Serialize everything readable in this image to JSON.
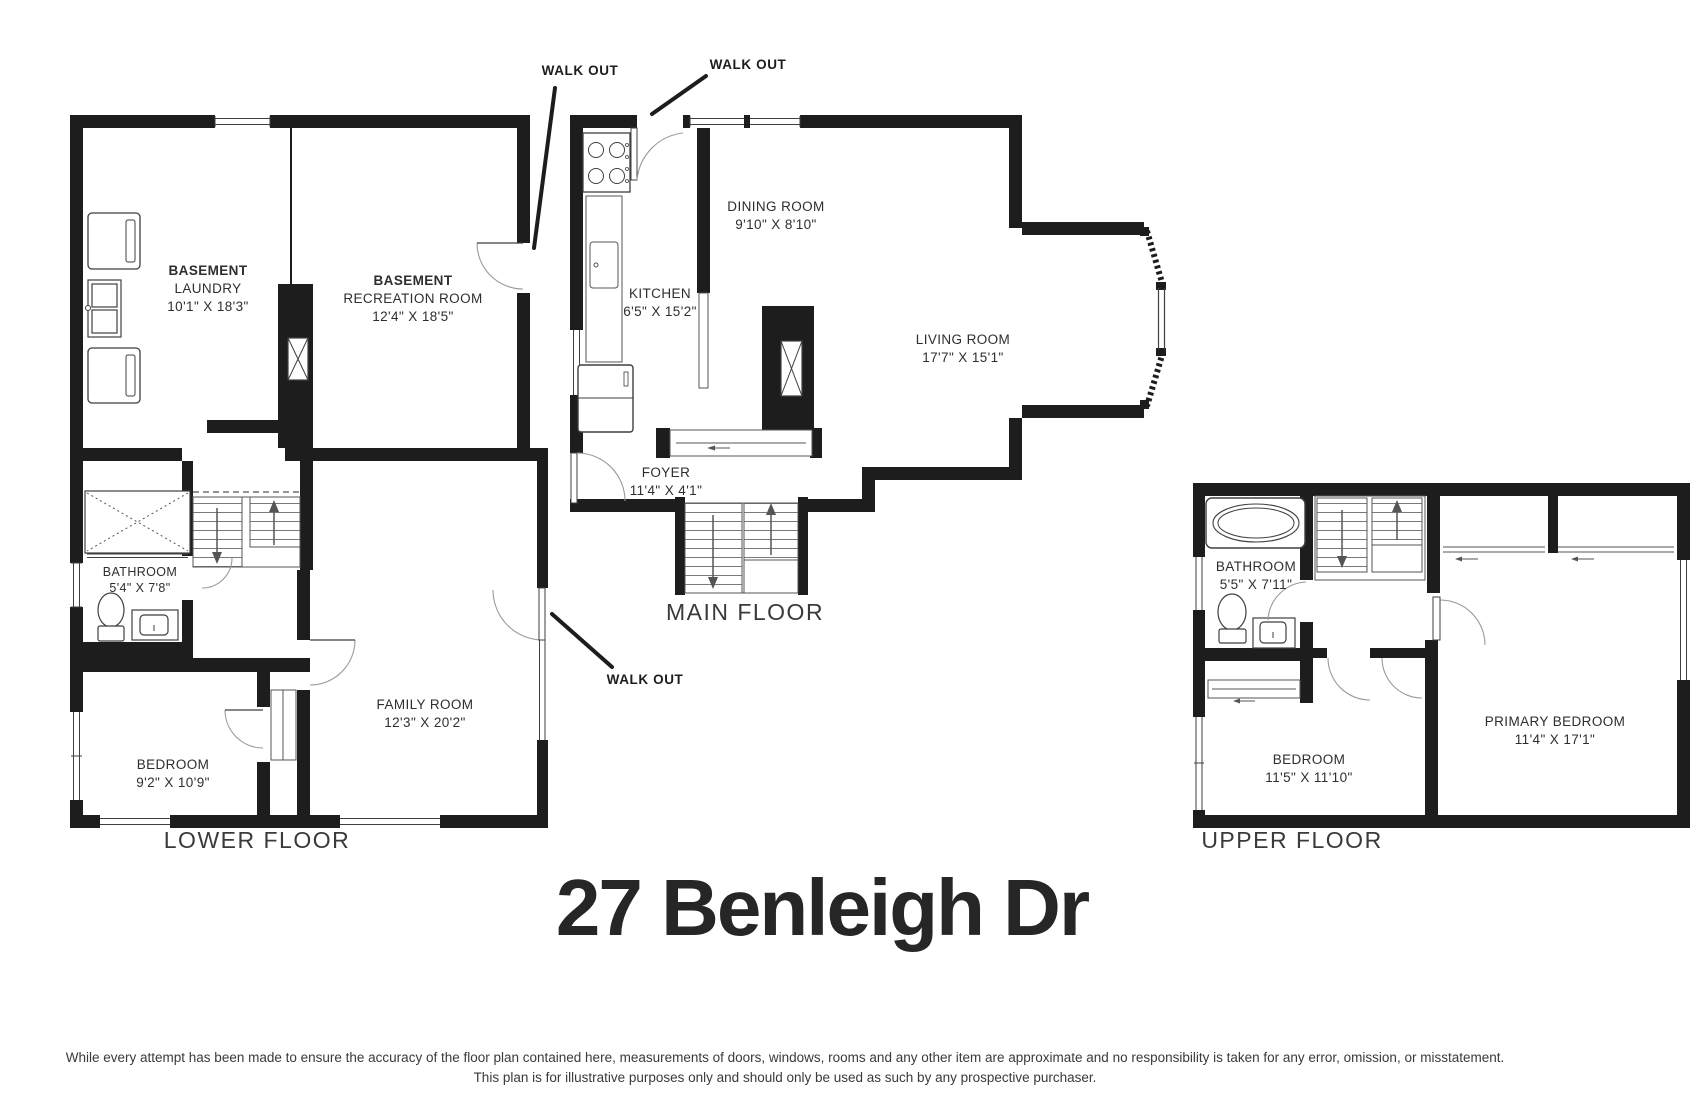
{
  "title": "27 Benleigh Dr",
  "annotations": {
    "walkout_rec": "WALK OUT",
    "walkout_kitchen": "WALK OUT",
    "walkout_family": "WALK OUT"
  },
  "floors": {
    "lower": {
      "label": "LOWER FLOOR",
      "rooms": {
        "laundry": {
          "l1": "BASEMENT",
          "l2": "LAUNDRY",
          "dims": "10'1\" X 18'3\""
        },
        "rec": {
          "l1": "BASEMENT",
          "l2": "RECREATION ROOM",
          "dims": "12'4\" X 18'5\""
        },
        "bathroom": {
          "l1": "BATHROOM",
          "dims": "5'4\" X 7'8\""
        },
        "bedroom": {
          "l1": "BEDROOM",
          "dims": "9'2\" X 10'9\""
        },
        "family": {
          "l1": "FAMILY ROOM",
          "dims": "12'3\" X 20'2\""
        }
      }
    },
    "main": {
      "label": "MAIN FLOOR",
      "rooms": {
        "kitchen": {
          "l1": "KITCHEN",
          "dims": "6'5\" X 15'2\""
        },
        "dining": {
          "l1": "DINING ROOM",
          "dims": "9'10\" X 8'10\""
        },
        "living": {
          "l1": "LIVING ROOM",
          "dims": "17'7\" X 15'1\""
        },
        "foyer": {
          "l1": "FOYER",
          "dims": "11'4\" X 4'1\""
        }
      }
    },
    "upper": {
      "label": "UPPER FLOOR",
      "rooms": {
        "bathroom": {
          "l1": "BATHROOM",
          "dims": "5'5\" X 7'11\""
        },
        "bedroom": {
          "l1": "BEDROOM",
          "dims": "11'5\" X 11'10\""
        },
        "primary": {
          "l1": "PRIMARY BEDROOM",
          "dims": "11'4\" X 17'1\""
        }
      }
    }
  },
  "disclaimer": {
    "line1": "While every attempt has been made to ensure the accuracy of the floor plan contained here, measurements of doors, windows, rooms and any other item are approximate and no responsibility is taken for any error, omission, or misstatement.",
    "line2": "This plan is for illustrative purposes only and should only be used as such by any prospective purchaser."
  },
  "colors": {
    "wall": "#1d1d1d",
    "text": "#3a3a3a"
  }
}
